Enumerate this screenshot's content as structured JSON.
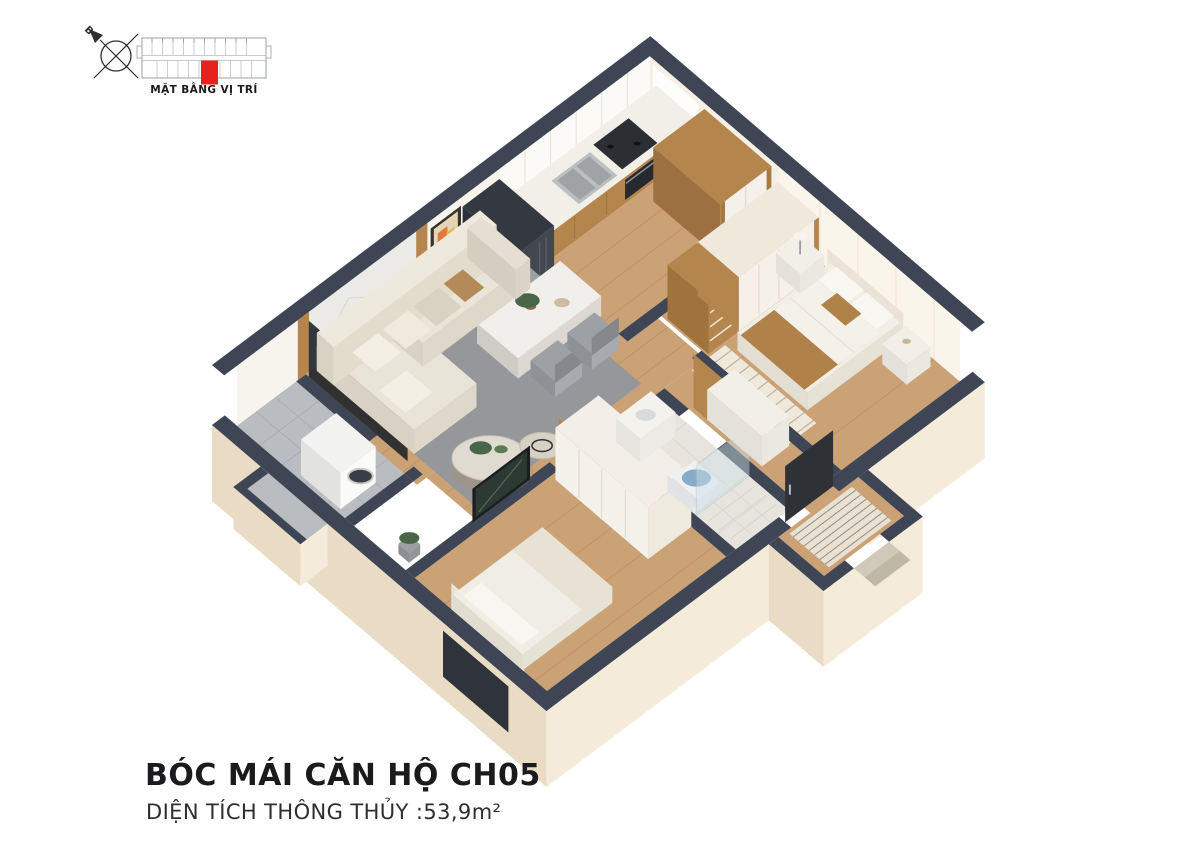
{
  "locator": {
    "caption": "MẶT BẰNG VỊ TRÍ",
    "compass_label": "B",
    "highlight_color": "#e8211d"
  },
  "footer": {
    "title": "BÓC MÁI CĂN HỘ CH05",
    "subtitle": "DIỆN TÍCH THÔNG THỦY :53,9m²"
  },
  "palette": {
    "wall": "#3e4554",
    "wood_floor": "#cba176",
    "wood_line": "#b98f60",
    "tile": "#b9bcc0",
    "tile_line": "#a7aaae",
    "bath_tile": "#e7e4de",
    "bath_line": "#d8d5cf",
    "cream": "#f4ebda",
    "cream_dark": "#eadcc4",
    "cabinet_wood": "#b5854e",
    "counter_top": "#f2efe9",
    "white_furn": "#f4f1ea",
    "sofa": "#e9e4d8",
    "rug": "#8f969e",
    "blanket": "#b08149",
    "glass": "#cfe2ea",
    "door_dark": "#2e3237",
    "screen_dark": "#1b1d21",
    "plant": "#4a6648",
    "face_white": "#f7f4ee",
    "face_cream": "#f6f0e4",
    "marble": "#eceae7",
    "glow": "#fbfaf6",
    "window_notch": "#ccd5da"
  }
}
